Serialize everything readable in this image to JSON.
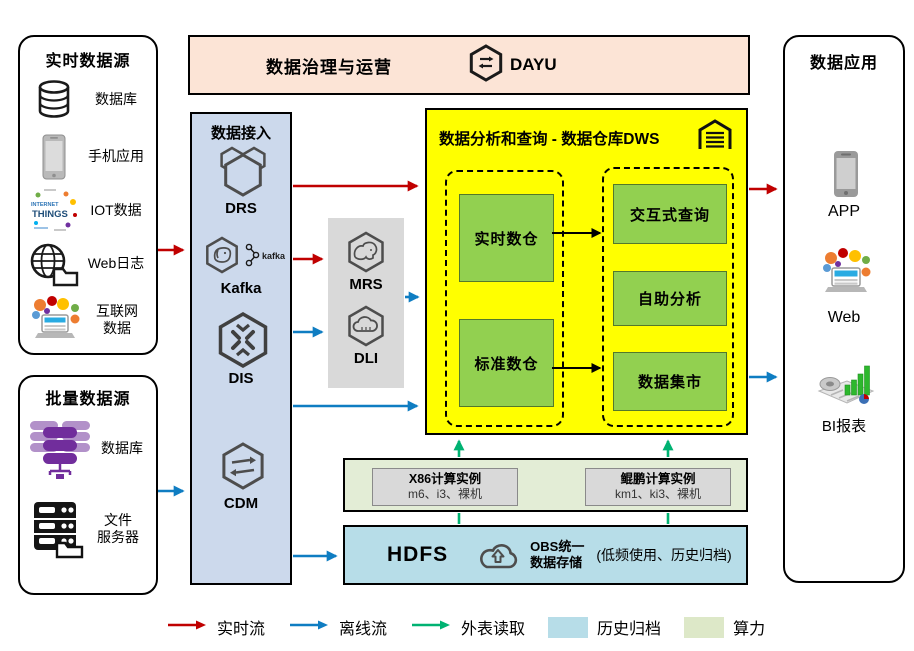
{
  "colors": {
    "realtime_flow": "#c00000",
    "offline_flow": "#0f7dc2",
    "external_read": "#00b272",
    "archive_fill": "#b7dde8",
    "compute_fill": "#e3edd6",
    "dws_fill": "#ffff00",
    "warehouse_green": "#92d050",
    "governance_fill": "#fce4d6",
    "ingestion_fill": "#ccd9ec",
    "processing_fill": "#d9d9d9"
  },
  "realtime_sources": {
    "title": "实时数据源",
    "items": [
      "数据库",
      "手机应用",
      "IOT数据",
      "Web日志",
      "互联网\n数据"
    ]
  },
  "batch_sources": {
    "title": "批量数据源",
    "items": [
      "数据库",
      "文件\n服务器"
    ]
  },
  "governance": {
    "title": "数据治理与运营",
    "product": "DAYU"
  },
  "ingestion": {
    "title": "数据接入",
    "services": [
      "DRS",
      "Kafka",
      "DIS",
      "CDM"
    ],
    "kafka_badge": "kafka"
  },
  "processing": {
    "services": [
      "MRS",
      "DLI"
    ]
  },
  "dws": {
    "title": "数据分析和查询 - 数据仓库DWS",
    "warehouses": [
      "实时数仓",
      "标准数仓"
    ],
    "services": [
      "交互式查询",
      "自助分析",
      "数据集市"
    ]
  },
  "compute": {
    "instances": [
      {
        "title": "X86计算实例",
        "specs": "m6、i3、裸机"
      },
      {
        "title": "鲲鹏计算实例",
        "specs": "km1、ki3、裸机"
      }
    ]
  },
  "storage": {
    "hdfs": "HDFS",
    "obs": "OBS统一\n数据存储",
    "note": "(低频使用、历史归档)"
  },
  "applications": {
    "title": "数据应用",
    "items": [
      "APP",
      "Web",
      "BI报表"
    ]
  },
  "legend": {
    "realtime": "实时流",
    "offline": "离线流",
    "external": "外表读取",
    "archive": "历史归档",
    "compute": "算力"
  },
  "iot_words": {
    "line1": "INTERNET",
    "line2": "THINGS"
  }
}
